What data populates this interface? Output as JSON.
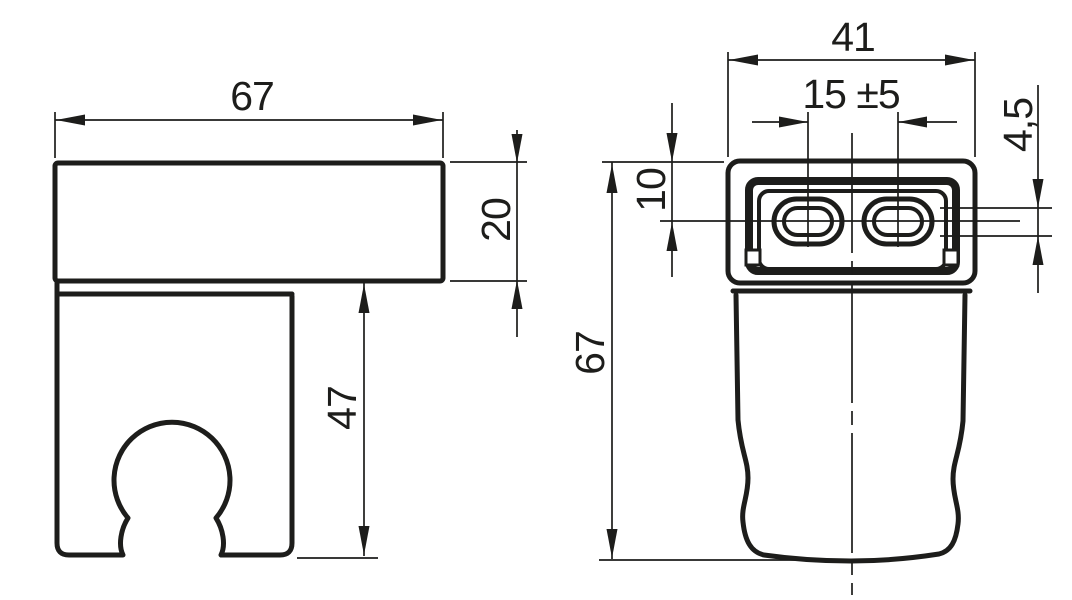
{
  "page": {
    "background": "#ffffff",
    "ink_color": "#1d1d1b",
    "drawing_type": "technical-dimension-drawing"
  },
  "side_view": {
    "dim_width": "67",
    "dim_block_height": "20",
    "dim_clip_height": "47"
  },
  "front_view": {
    "dim_width": "41",
    "dim_hole_spacing": "15 ±5",
    "dim_slot_height": "4,5",
    "dim_hole_offset": "10",
    "dim_total_height": "67"
  }
}
